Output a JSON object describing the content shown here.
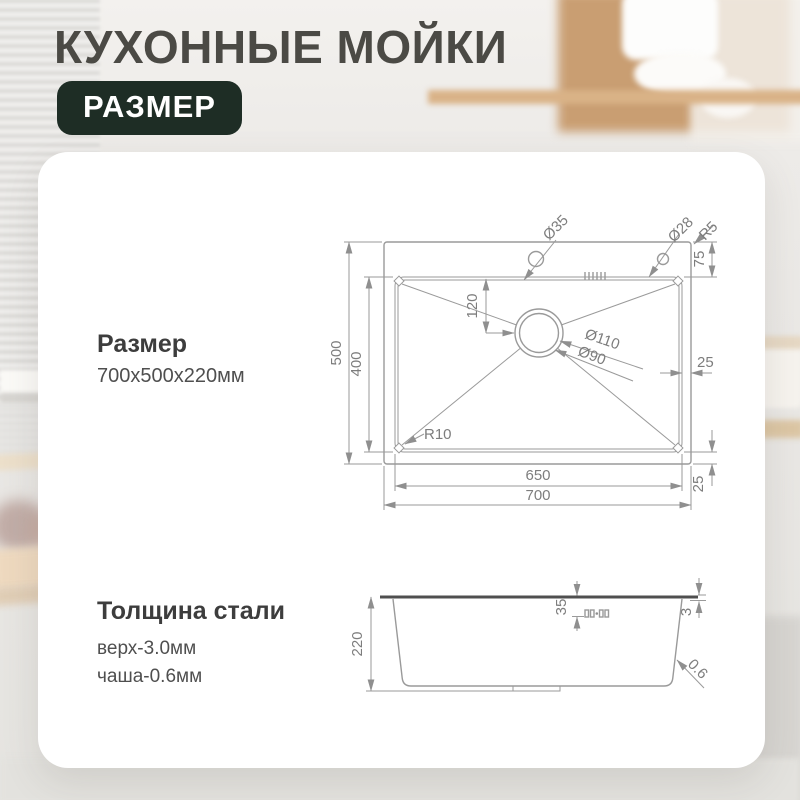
{
  "header": {
    "title": "КУХОННЫЕ МОЙКИ",
    "badge": "РАЗМЕР"
  },
  "size_block": {
    "heading": "Размер",
    "value": "700x500x220мм"
  },
  "thickness_block": {
    "heading": "Толщина стали",
    "top_line": "верх-3.0мм",
    "bowl_line": "чаша-0.6мм"
  },
  "top_view": {
    "width_outer": "700",
    "width_inner": "650",
    "height_outer": "500",
    "height_inner": "400",
    "rim_top": "75",
    "rim_right": "25",
    "rim_bottom": "25",
    "drain_offset": "120",
    "drain_outer": "Ø110",
    "drain_inner": "Ø90",
    "faucet_hole": "Ø35",
    "second_hole": "Ø28",
    "corner_outer": "R5",
    "corner_inner": "R10"
  },
  "side_view": {
    "height": "220",
    "overflow_offset": "35",
    "rim_thickness": "3",
    "wall_thickness": "0.6"
  },
  "colors": {
    "badge_bg": "#1e2d25",
    "title_text": "#4b4a45",
    "drawing_line": "#9a9a9a",
    "drawing_text": "#7d7d7d"
  }
}
